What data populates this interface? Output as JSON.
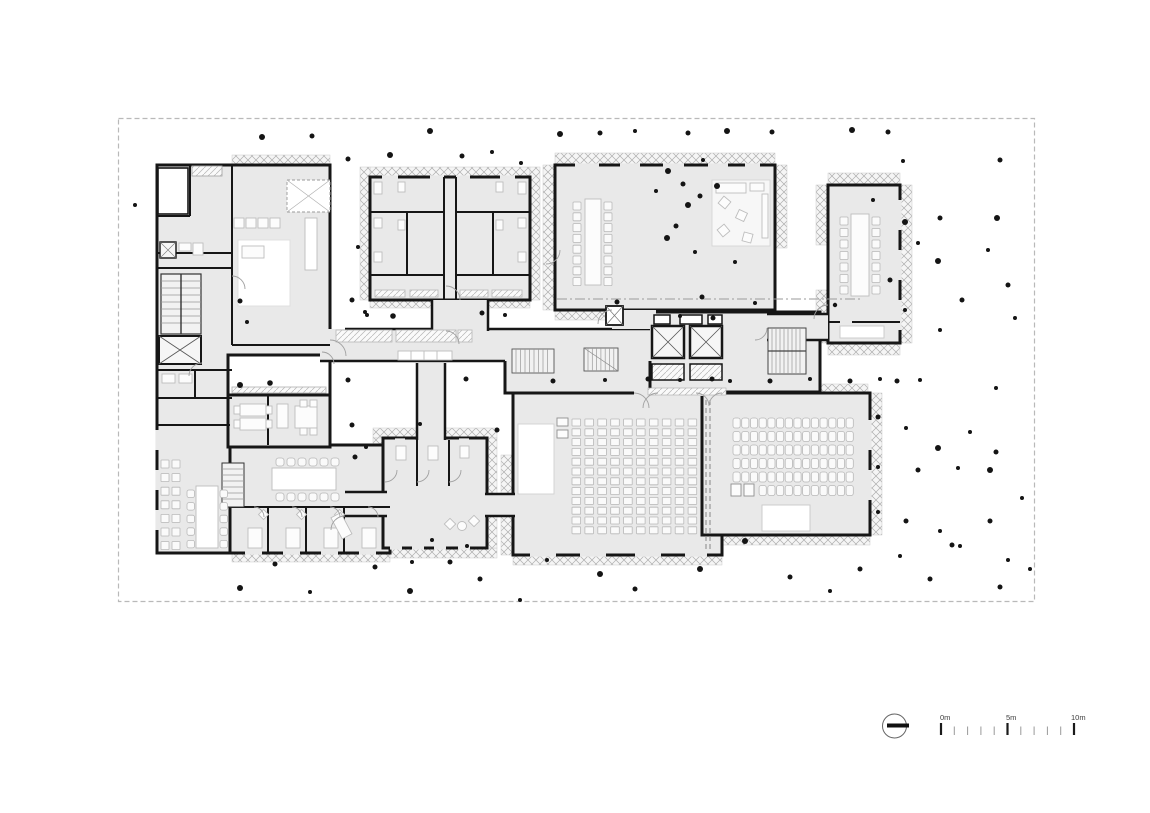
{
  "colors": {
    "wall": "#161616",
    "room_fill": "#e9e9e9",
    "white_room": "#ffffff",
    "hatch_line": "#aeaeae",
    "hatch_bg": "#f5f5f5",
    "furniture_stroke": "#bdbdbd",
    "furniture_fill": "#fcfcfc",
    "seat_fill": "#fafafa",
    "seat_stroke": "#b8b8b8",
    "dot": "#141414",
    "site_border": "#b9b9b9",
    "tick_major": "#1a1a1a",
    "tick_minor": "#999999"
  },
  "scale_bar": {
    "labels": [
      {
        "text": "0m",
        "m": 0
      },
      {
        "text": "5m",
        "m": 5
      },
      {
        "text": "10m",
        "m": 10
      }
    ],
    "origin_x": 941,
    "unit_px": 13.3,
    "tick_top_major": 723,
    "tick_top_minor": 726.5,
    "tick_bottom": 735,
    "ticks": [
      {
        "m": 0,
        "major": true
      },
      {
        "m": 1
      },
      {
        "m": 2
      },
      {
        "m": 3
      },
      {
        "m": 4
      },
      {
        "m": 5,
        "major": true
      },
      {
        "m": 6
      },
      {
        "m": 7
      },
      {
        "m": 8
      },
      {
        "m": 9
      },
      {
        "m": 10,
        "major": true
      }
    ]
  },
  "north_symbol": {
    "shape": "circle-with-bar"
  },
  "dots": [
    [
      262,
      137,
      3
    ],
    [
      312,
      136,
      2.5
    ],
    [
      430,
      131,
      3
    ],
    [
      560,
      134,
      3
    ],
    [
      600,
      133,
      2.5
    ],
    [
      635,
      131,
      2
    ],
    [
      688,
      133,
      2.5
    ],
    [
      727,
      131,
      3
    ],
    [
      772,
      132,
      2.5
    ],
    [
      852,
      130,
      3
    ],
    [
      888,
      132,
      2.5
    ],
    [
      348,
      159,
      2.5
    ],
    [
      390,
      155,
      3
    ],
    [
      462,
      156,
      2.5
    ],
    [
      492,
      152,
      2
    ],
    [
      521,
      163,
      2
    ],
    [
      1000,
      160,
      2.5
    ],
    [
      903,
      161,
      2
    ],
    [
      873,
      200,
      2
    ],
    [
      940,
      218,
      2.5
    ],
    [
      997,
      218,
      3
    ],
    [
      905,
      222,
      3
    ],
    [
      918,
      243,
      2
    ],
    [
      988,
      250,
      2
    ],
    [
      938,
      261,
      3
    ],
    [
      962,
      300,
      2.5
    ],
    [
      1008,
      285,
      2.5
    ],
    [
      890,
      280,
      2.5
    ],
    [
      940,
      330,
      2
    ],
    [
      905,
      310,
      2
    ],
    [
      1015,
      318,
      2
    ],
    [
      996,
      388,
      2
    ],
    [
      668,
      171,
      3
    ],
    [
      703,
      160,
      2
    ],
    [
      683,
      184,
      2.5
    ],
    [
      717,
      186,
      3
    ],
    [
      656,
      191,
      2
    ],
    [
      700,
      196,
      2.5
    ],
    [
      688,
      205,
      3
    ],
    [
      676,
      226,
      2.5
    ],
    [
      667,
      238,
      3
    ],
    [
      695,
      252,
      2
    ],
    [
      735,
      262,
      2
    ],
    [
      702,
      297,
      2.5
    ],
    [
      680,
      316,
      2
    ],
    [
      713,
      318,
      2.5
    ],
    [
      755,
      303,
      2
    ],
    [
      835,
      305,
      2.2
    ],
    [
      617,
      302,
      2.5
    ],
    [
      358,
      247,
      2
    ],
    [
      240,
      301,
      2.5
    ],
    [
      247,
      322,
      2
    ],
    [
      352,
      300,
      2.5
    ],
    [
      365,
      312,
      2
    ],
    [
      367,
      315,
      2
    ],
    [
      393,
      316,
      2.8
    ],
    [
      482,
      313,
      2.5
    ],
    [
      505,
      315,
      2
    ],
    [
      240,
      385,
      3
    ],
    [
      270,
      383,
      2.8
    ],
    [
      348,
      380,
      2.5
    ],
    [
      352,
      425,
      2.5
    ],
    [
      366,
      447,
      2
    ],
    [
      355,
      457,
      2.5
    ],
    [
      420,
      424,
      2
    ],
    [
      466,
      379,
      2.5
    ],
    [
      497,
      430,
      2.5
    ],
    [
      553,
      381,
      2.5
    ],
    [
      605,
      380,
      2
    ],
    [
      648,
      379,
      2.5
    ],
    [
      680,
      380,
      2
    ],
    [
      712,
      379,
      2.5
    ],
    [
      730,
      381,
      2
    ],
    [
      770,
      381,
      2.5
    ],
    [
      810,
      379,
      2
    ],
    [
      850,
      381,
      2.5
    ],
    [
      880,
      379,
      2
    ],
    [
      897,
      381,
      2.5
    ],
    [
      920,
      380,
      2
    ],
    [
      878,
      417,
      2.5
    ],
    [
      906,
      428,
      2
    ],
    [
      938,
      448,
      3
    ],
    [
      970,
      432,
      2
    ],
    [
      996,
      452,
      2.5
    ],
    [
      878,
      467,
      2
    ],
    [
      918,
      470,
      2.5
    ],
    [
      958,
      468,
      2
    ],
    [
      990,
      470,
      3
    ],
    [
      878,
      512,
      2
    ],
    [
      906,
      521,
      2.5
    ],
    [
      940,
      531,
      2
    ],
    [
      990,
      521,
      2.5
    ],
    [
      1008,
      560,
      2
    ],
    [
      952,
      545,
      2.5
    ],
    [
      1022,
      498,
      2
    ],
    [
      432,
      540,
      2
    ],
    [
      450,
      562,
      2.5
    ],
    [
      467,
      546,
      2
    ],
    [
      412,
      562,
      2
    ],
    [
      240,
      588,
      3
    ],
    [
      275,
      564,
      2.5
    ],
    [
      310,
      592,
      2
    ],
    [
      375,
      567,
      2.5
    ],
    [
      410,
      591,
      3
    ],
    [
      480,
      579,
      2.5
    ],
    [
      520,
      600,
      2
    ],
    [
      547,
      560,
      2
    ],
    [
      600,
      574,
      3
    ],
    [
      635,
      589,
      2.5
    ],
    [
      700,
      569,
      3
    ],
    [
      745,
      541,
      3
    ],
    [
      790,
      577,
      2.5
    ],
    [
      830,
      591,
      2
    ],
    [
      860,
      569,
      2.5
    ],
    [
      900,
      556,
      2
    ],
    [
      930,
      579,
      2.5
    ],
    [
      960,
      546,
      2
    ],
    [
      1000,
      587,
      2.5
    ],
    [
      1030,
      569,
      2
    ],
    [
      135,
      205,
      2
    ]
  ],
  "seat_grids": [
    {
      "name": "auditorium-seats",
      "x": 572,
      "y": 419,
      "cols": 10,
      "rows": 12,
      "dx": 12.9,
      "dy": 9.8,
      "w": 8.6,
      "h": 7,
      "rx": 0.5
    },
    {
      "name": "hall-right-seats",
      "x": 733,
      "y": 418,
      "cols": 14,
      "rows": 5,
      "dx": 8.7,
      "dy": 13.5,
      "w": 7.2,
      "h": 10,
      "rx": 2.2
    },
    {
      "name": "hall-right-last-row",
      "x": 759.1,
      "y": 485.5,
      "cols": 11,
      "rows": 1,
      "dx": 8.7,
      "dy": 0,
      "w": 7.2,
      "h": 10,
      "rx": 2.2
    },
    {
      "name": "meeting-hall-chairs-left",
      "x": 573,
      "y": 202,
      "cols": 1,
      "rows": 8,
      "dx": 0,
      "dy": 10.8,
      "w": 8,
      "h": 8,
      "rx": 1
    },
    {
      "name": "meeting-hall-chairs-right",
      "x": 604,
      "y": 202,
      "cols": 1,
      "rows": 8,
      "dx": 0,
      "dy": 10.8,
      "w": 8,
      "h": 8,
      "rx": 1
    },
    {
      "name": "annex-chairs-left",
      "x": 840,
      "y": 217,
      "cols": 1,
      "rows": 7,
      "dx": 0,
      "dy": 11.5,
      "w": 8,
      "h": 8,
      "rx": 1
    },
    {
      "name": "annex-chairs-right",
      "x": 872,
      "y": 217,
      "cols": 1,
      "rows": 7,
      "dx": 0,
      "dy": 11.5,
      "w": 8,
      "h": 8,
      "rx": 1
    },
    {
      "name": "canteen-chairs-top",
      "x": 276,
      "y": 458,
      "cols": 6,
      "rows": 1,
      "dx": 11,
      "dy": 0,
      "w": 8,
      "h": 8,
      "rx": 2.5
    },
    {
      "name": "canteen-chairs-bottom",
      "x": 276,
      "y": 493,
      "cols": 6,
      "rows": 1,
      "dx": 11,
      "dy": 0,
      "w": 8,
      "h": 8,
      "rx": 2.5
    },
    {
      "name": "canteen2-chairs-left",
      "x": 187,
      "y": 490,
      "cols": 1,
      "rows": 5,
      "dx": 0,
      "dy": 12.6,
      "w": 7.5,
      "h": 7.5,
      "rx": 2
    },
    {
      "name": "canteen2-chairs-right",
      "x": 220,
      "y": 490,
      "cols": 1,
      "rows": 5,
      "dx": 0,
      "dy": 12.6,
      "w": 7.5,
      "h": 7.5,
      "rx": 2
    },
    {
      "name": "west-wall-benches",
      "x": 161,
      "y": 460,
      "cols": 2,
      "rows": 7,
      "dx": 11,
      "dy": 13.6,
      "w": 8,
      "h": 8,
      "rx": 0.5
    }
  ]
}
